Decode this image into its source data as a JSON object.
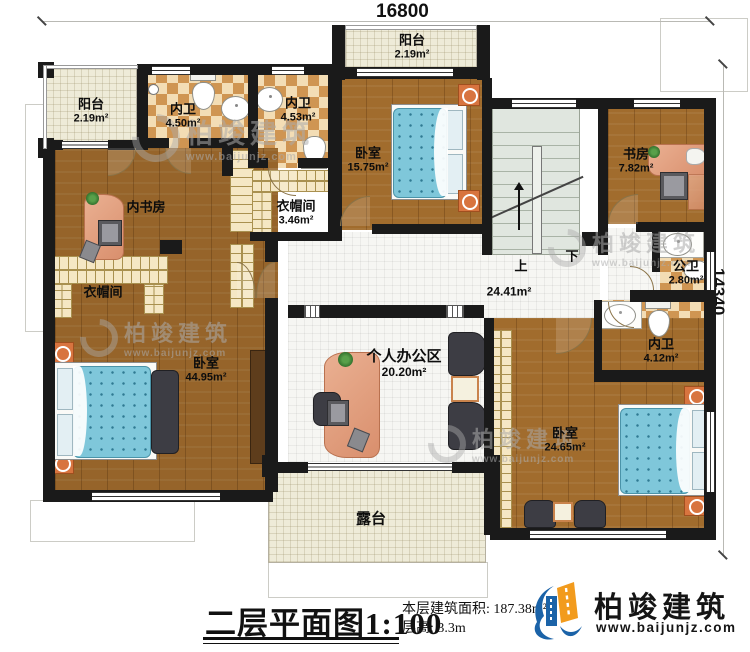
{
  "dimensions": {
    "width": "16800",
    "height": "14340"
  },
  "rooms": {
    "balcony_top": {
      "name": "阳台",
      "area": "2.19m²"
    },
    "balcony_left": {
      "name": "阳台",
      "area": "2.19m²"
    },
    "bath_a": {
      "name": "内卫",
      "area": "4.50m²"
    },
    "bath_b": {
      "name": "内卫",
      "area": "4.53m²"
    },
    "bedroom_top": {
      "name": "卧室",
      "area": "15.75m²"
    },
    "study": {
      "name": "书房",
      "area": "7.82m²"
    },
    "inner_study": {
      "name": "内书房"
    },
    "closet_top": {
      "name": "衣帽间",
      "area": "3.46m²"
    },
    "closet_master": {
      "name": "衣帽间"
    },
    "master_bedroom": {
      "name": "卧室",
      "area": "44.95m²"
    },
    "office": {
      "name": "个人办公区",
      "area": "20.20m²"
    },
    "hall": {
      "area": "24.41m²"
    },
    "public_bath": {
      "name": "公卫",
      "area": "2.80m²"
    },
    "bath_c": {
      "name": "内卫",
      "area": "4.12m²"
    },
    "bedroom_right": {
      "name": "卧室",
      "area": "24.65m²"
    },
    "terrace": {
      "name": "露台"
    }
  },
  "stairs": {
    "up": "上",
    "down": "下"
  },
  "title_block": {
    "title": "二层平面图",
    "scale": "1:100",
    "area_label": "本层建筑面积:",
    "area_value": "187.38m²",
    "floor_height_label": "层高:",
    "floor_height_value": "3.3m"
  },
  "brand": {
    "name": "柏竣建筑",
    "website": "www.baijunjz.com"
  },
  "watermark": {
    "name": "柏竣建筑",
    "website": "www.baijunjz.com"
  },
  "colors": {
    "wall": "#1a1a1a",
    "wood": "#a16c2d",
    "checker_dark": "#cf9552",
    "checker_light": "#f3ddb5",
    "tile": "#eeebd8",
    "mosaic": "#f6f6f3",
    "stairs": "#e0e6df",
    "bed": "#7fc7da",
    "desk": "#e0987a",
    "accent": "#d8743f",
    "brand_blue": "#1b63a8",
    "brand_orange": "#f29b1d"
  }
}
